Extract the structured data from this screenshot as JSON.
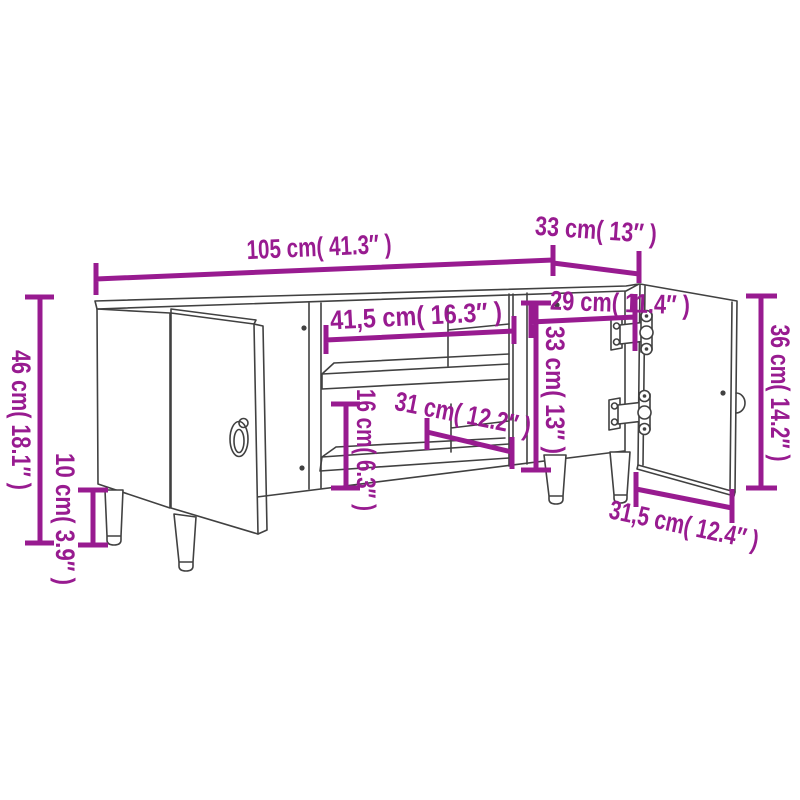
{
  "diagram": {
    "subject": "tv-stand-dimension-diagram",
    "accent_color": "#981B90",
    "line_color": "#414141",
    "background_color": "#ffffff",
    "dims": {
      "overall_width": "105 cm( 41.3″ )",
      "overall_depth": "33 cm( 13″ )",
      "overall_height": "46 cm( 18.1″ )",
      "leg_height": "10 cm( 3.9″ )",
      "right_door_height": "36 cm( 14.2″ )",
      "middle_opening_width": "41,5 cm( 16.3″ )",
      "right_opening_width": "29 cm( 11.4″ )",
      "right_opening_height": "33 cm( 13″ )",
      "lower_opening_height": "16 cm( 6.3″ )",
      "lower_opening_depth": "31 cm( 12.2″ )",
      "right_door_width": "31,5 cm( 12.4″ )"
    }
  }
}
